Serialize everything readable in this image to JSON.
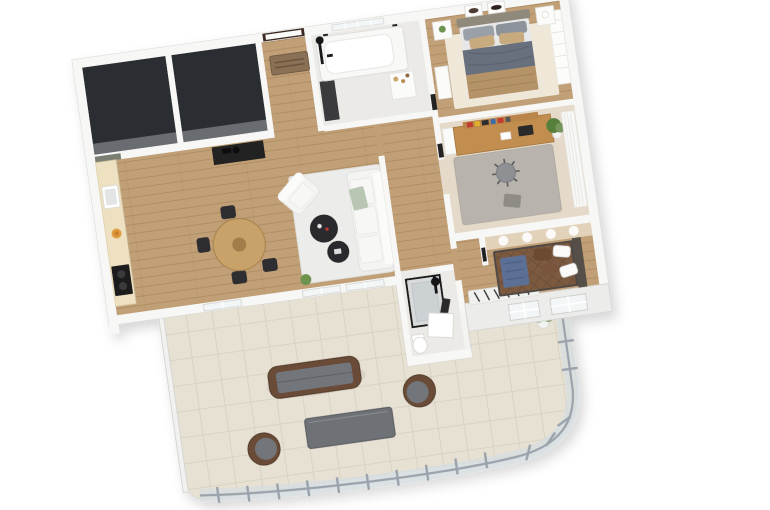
{
  "scene": {
    "type": "3d-floor-plan-render",
    "view": "top-down tilted axonometric",
    "rotation_deg": -8,
    "background": "#ffffff"
  },
  "palette": {
    "wall": "#f3f3f1",
    "wall_bright": "#f7f7f5",
    "wood_floor": "#c2a077",
    "dark_room_floor": "#2c2e30",
    "dark_room_face": "#74777a",
    "bath_floor": "#eceae6",
    "office_floor": "#e5dac9",
    "tile_terrace": "#e7e1d3",
    "rug_living": "#ececea",
    "rug_master": "#efe8d9",
    "rug_office": "#b8b4ad",
    "rug_zebra": "#f1f1ef",
    "sofa_white": "#f4f4f2",
    "throw_green": "#b9c6b4",
    "coffee_table_dark": "#2c2c2e",
    "dining_table_wood": "#c9a269",
    "chair_dark": "#2e2e30",
    "console_dark": "#232323",
    "counter_cream": "#eee1c2",
    "sage_wall": "#7a7d72",
    "cooktop_black": "#1b1c1d",
    "fruit_orange": "#e09b3d",
    "door_frame_dark": "#3c2c20",
    "doormat_brown": "#8a7154",
    "fixture_black": "#1a1a1a",
    "cabinet_dark": "#3a3a3c",
    "bed_headboard": "#8f897b",
    "bed_duvet_gray": "#67707d",
    "bed_blanket_tan": "#b49367",
    "pillow_tan": "#c8aa7f",
    "pillow_gray": "#9aa0a8",
    "white_furniture": "#fbfbfa",
    "desk_wood": "#c28e50",
    "shelf_wood": "#b9854a",
    "book_red": "#c13a2e",
    "book_yellow": "#e0af2c",
    "book_blue": "#3b6ea5",
    "laptop_dark": "#2b2b2b",
    "office_chair_gray": "#8e9094",
    "plant_green": "#6d9350",
    "plant_green_dark": "#557f3a",
    "lit_wall_beige": "#e2d2b9",
    "quilt_brown": "#7b5a41",
    "pillow_brown": "#6d4a33",
    "blanket_blue": "#5c6f96",
    "bed_frame_dark": "#4f4a44",
    "wicker_brown": "#6a4c38",
    "cushion_gray": "#72767a",
    "outdoor_table_gray": "#6e7276",
    "railing_glass": "#d6dce1",
    "railing_metal": "#9aa2ab",
    "window_glass": "#f2f6f7",
    "shower_glass": "#aab3ba",
    "tub_white": "#ffffff"
  },
  "rooms": [
    {
      "id": "dark-room-1",
      "furniture": []
    },
    {
      "id": "dark-room-2",
      "furniture": []
    },
    {
      "id": "entry",
      "furniture": [
        "front-door",
        "doormat",
        "dark-cabinet"
      ]
    },
    {
      "id": "bathroom",
      "furniture": [
        "bathtub",
        "shower-fixture",
        "vanity",
        "north-window"
      ]
    },
    {
      "id": "master-bedroom",
      "furniture": [
        "double-bed",
        "nightstand-left",
        "nightstand-right",
        "wall-art-1",
        "wall-art-2",
        "dresser",
        "rug",
        "window-blinds"
      ]
    },
    {
      "id": "kitchen",
      "furniture": [
        "counter",
        "sink",
        "cooktop",
        "fruit-bowl"
      ]
    },
    {
      "id": "living-dining",
      "furniture": [
        "console-table",
        "dining-table",
        "dining-chairs",
        "sofa",
        "armchair",
        "coffee-table-1",
        "coffee-table-2",
        "rug",
        "south-windows",
        "small-plant"
      ]
    },
    {
      "id": "hallway",
      "furniture": [
        "open-door-tops"
      ]
    },
    {
      "id": "office",
      "furniture": [
        "desk",
        "book-shelf",
        "laptop",
        "office-chair",
        "rug",
        "plant",
        "curtain",
        "east-window"
      ]
    },
    {
      "id": "bedroom-2",
      "furniture": [
        "double-bed",
        "blue-blanket",
        "pillows",
        "zebra-rug",
        "ceiling-spotlights",
        "south-windows"
      ]
    },
    {
      "id": "shower-room",
      "furniture": [
        "glass-shower",
        "shower-head",
        "toilet",
        "white-door-panel",
        "towel"
      ]
    },
    {
      "id": "terrace",
      "furniture": [
        "outdoor-sofa",
        "outdoor-table",
        "wicker-chair-1",
        "wicker-chair-2",
        "corner-plant",
        "glass-railing",
        "west-parapet"
      ]
    }
  ]
}
